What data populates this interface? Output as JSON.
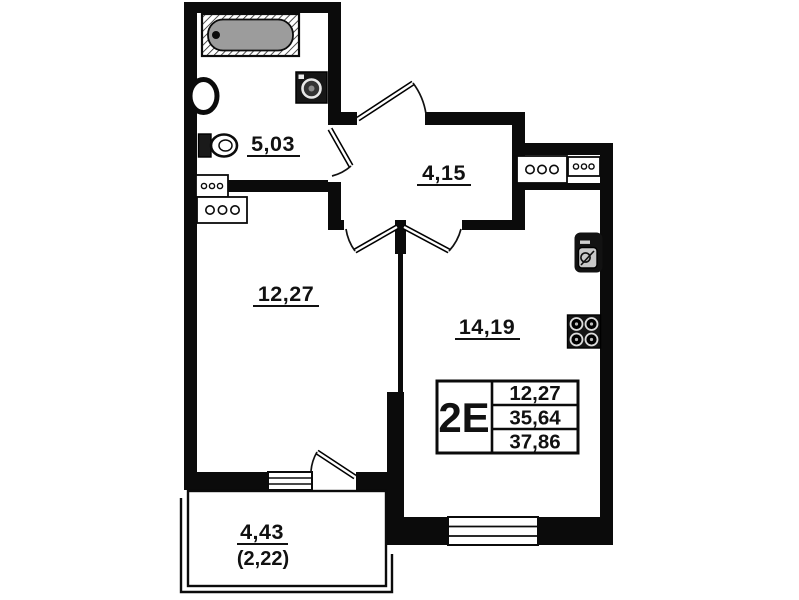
{
  "rooms": [
    {
      "name": "bathroom",
      "area": "5,03"
    },
    {
      "name": "hallway",
      "area": "4,15"
    },
    {
      "name": "room",
      "area": "12,27"
    },
    {
      "name": "kitchen-living-room",
      "area": "14,19"
    },
    {
      "name": "balcony",
      "area": "4,43",
      "area_with_coefficient": "(2,22)"
    }
  ],
  "legend": {
    "apartment_type": "2E",
    "rows": [
      "12,27",
      "35,64",
      "37,86"
    ]
  },
  "colors": {
    "wall": "#0b0b0b",
    "background": "#ffffff",
    "bathtub_fill": "#9c9c9c"
  }
}
